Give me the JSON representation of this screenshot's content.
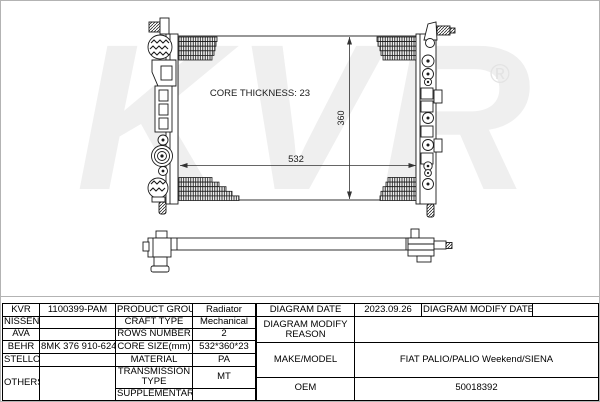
{
  "watermark": {
    "brand": "KVR",
    "registered_mark": "®"
  },
  "diagram": {
    "core_thickness_label": "CORE THICKNESS: 23",
    "core_width_mm": "532",
    "core_height_mm": "360"
  },
  "colors": {
    "line": "#1a1a1a",
    "table_border": "#000000",
    "frame": "#b3b3b3",
    "watermark": "#efefef"
  },
  "table": {
    "left_rows": [
      {
        "brand": "KVR",
        "code": "1100399-PAM",
        "label": "PRODUCT GROUP",
        "value": "Radiator"
      },
      {
        "brand": "NISSENS",
        "code": "",
        "label": "CRAFT TYPE",
        "value": "Mechanical"
      },
      {
        "brand": "AVA",
        "code": "",
        "label": "ROWS NUMBER",
        "value": "2"
      },
      {
        "brand": "BEHR",
        "code": "8MK 376 910-624",
        "label": "CORE SIZE(mm)",
        "value": "532*360*23"
      },
      {
        "brand": "STELLOX",
        "code": "",
        "label": "MATERIAL",
        "value": "PA"
      },
      {
        "brand": "OTHERS",
        "code": "",
        "label": "TRANSMISSION TYPE",
        "value": "MT"
      },
      {
        "label": "SUPPLEMENTARY",
        "value": ""
      }
    ],
    "right": {
      "diagram_date_label": "DIAGRAM DATE",
      "diagram_date_value": "2023.09.26",
      "modify_date_label": "DIAGRAM MODIFY DATE",
      "modify_date_value": "",
      "modify_reason_label": "DIAGRAM MODIFY REASON",
      "modify_reason_value": "",
      "make_model_label": "MAKE/MODEL",
      "make_model_value": "FIAT PALIO/PALIO Weekend/SIENA",
      "oem_label": "OEM",
      "oem_value": "50018392"
    }
  }
}
